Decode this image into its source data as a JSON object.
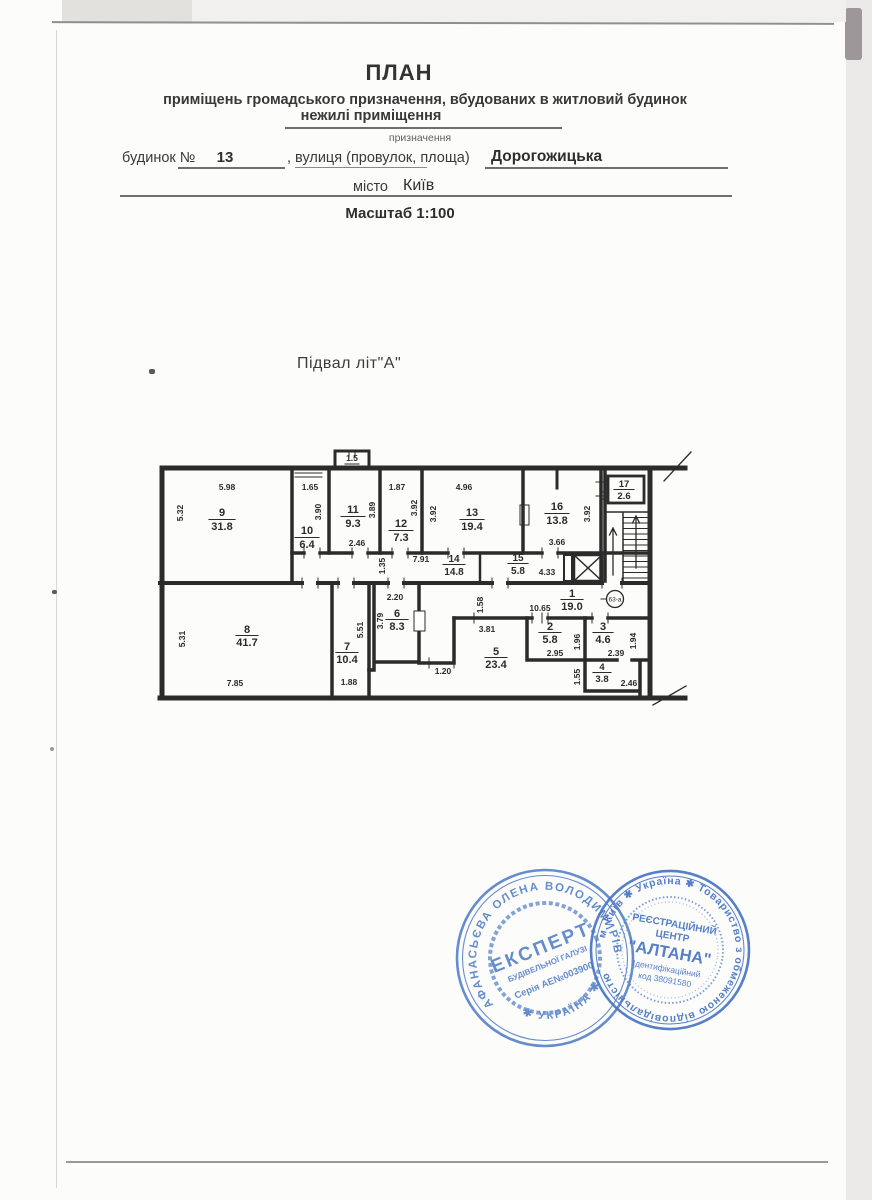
{
  "header": {
    "title": "ПЛАН",
    "subtitle": "приміщень громадського призначення, вбудованих в житловий будинок",
    "purpose_value": "нежилі приміщення",
    "purpose_caption": "призначення",
    "building_label": "будинок №",
    "building_number": "13",
    "street_label": ", вулиця (провулок, площа)",
    "street_value": "Дорогожицька",
    "city_label": "місто",
    "city_value": "Київ",
    "scale_label": "Масштаб 1:100"
  },
  "plan": {
    "caption": "Підвал літ\"А\"",
    "vestibule_area": "1.5",
    "badge": "63-а",
    "rooms": [
      {
        "no": "1",
        "area": "19.0",
        "dim_top": "10.65",
        "dim_side": "1.58"
      },
      {
        "no": "2",
        "area": "5.8",
        "dim_bottom": "2.95",
        "dim_side": "1.96"
      },
      {
        "no": "3",
        "area": "4.6",
        "dim_bottom": "2.39",
        "dim_side": "1.94"
      },
      {
        "no": "4",
        "area": "3.8",
        "dim_bottom": "2.46",
        "dim_side": "1.55"
      },
      {
        "no": "5",
        "area": "23.4",
        "dim_top": "3.81",
        "dim_bottom": "1.20"
      },
      {
        "no": "6",
        "area": "8.3",
        "dim_top": "2.20",
        "dim_side": "3.79"
      },
      {
        "no": "7",
        "area": "10.4",
        "dim_bottom": "1.88",
        "dim_side": "5.51"
      },
      {
        "no": "8",
        "area": "41.7",
        "dim_bottom": "7.85",
        "dim_side": "5.31"
      },
      {
        "no": "9",
        "area": "31.8",
        "dim_top": "5.98",
        "dim_side": "5.32"
      },
      {
        "no": "10",
        "area": "6.4",
        "dim_top": "1.65",
        "dim_side": "3.90"
      },
      {
        "no": "11",
        "area": "9.3",
        "dim_bottom": "2.46",
        "dim_side": "3.89"
      },
      {
        "no": "12",
        "area": "7.3",
        "dim_top": "1.87",
        "dim_side": "3.92"
      },
      {
        "no": "13",
        "area": "19.4",
        "dim_top": "4.96",
        "dim_side": "3.92"
      },
      {
        "no": "14",
        "area": "14.8",
        "dim_top": "7.91",
        "dim_side": "1.35"
      },
      {
        "no": "15",
        "area": "5.8",
        "dim_right": "4.33"
      },
      {
        "no": "16",
        "area": "13.8",
        "dim_bottom": "3.66",
        "dim_side": "3.92"
      },
      {
        "no": "17",
        "area": "2.6"
      }
    ]
  },
  "stamps": {
    "expert": {
      "arc_name": "АФАНАСЬЄВА ОЛЕНА ВОЛОДИМИРІВНА",
      "arc_bottom": "✱ УКРАЇНА ✱",
      "line1": "ЕКСПЕРТ",
      "line2": "БУДІВЕЛЬНОЇ ГАЛУЗІ",
      "line3": "Серія АЕ№003900"
    },
    "altana": {
      "arc_text": "м. Київ ✱ Україна ✱ Товариство з обмеженою відповідальністю",
      "line1": "РЕЄСТРАЦІЙНИЙ",
      "line2": "ЦЕНТР",
      "line3": "\"АЛТАНА\"",
      "line4": "Ідентифікаційний",
      "line5": "код 38091580"
    }
  }
}
